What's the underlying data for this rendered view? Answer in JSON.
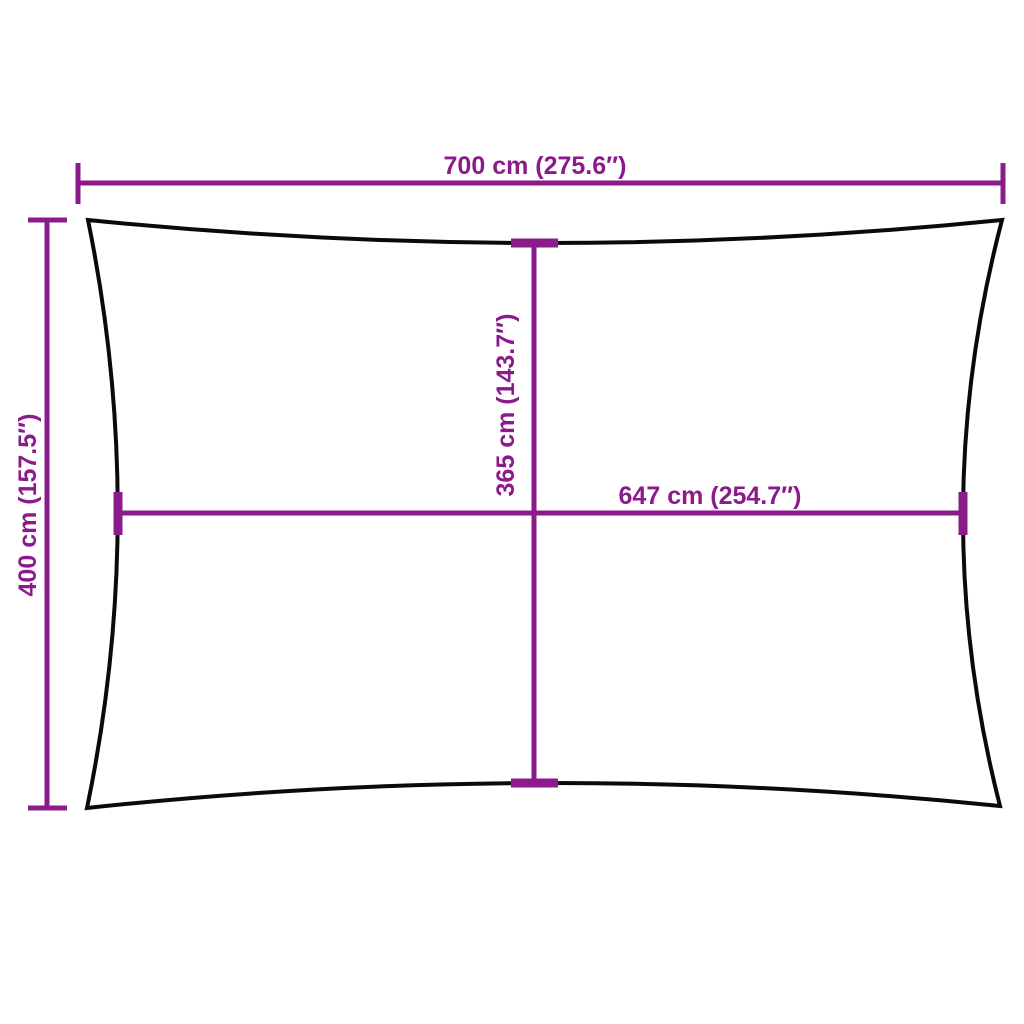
{
  "diagram": {
    "title": "shade-sail-dimension-diagram",
    "labels": {
      "outer_width": "700 cm (275.6″)",
      "outer_height": "400 cm (157.5″)",
      "inner_height": "365 cm (143.7″)",
      "inner_width": "647 cm (254.7″)"
    },
    "colors": {
      "dimension": "#8B1B8B",
      "outline": "#0a0a0a",
      "background": "#ffffff"
    }
  }
}
